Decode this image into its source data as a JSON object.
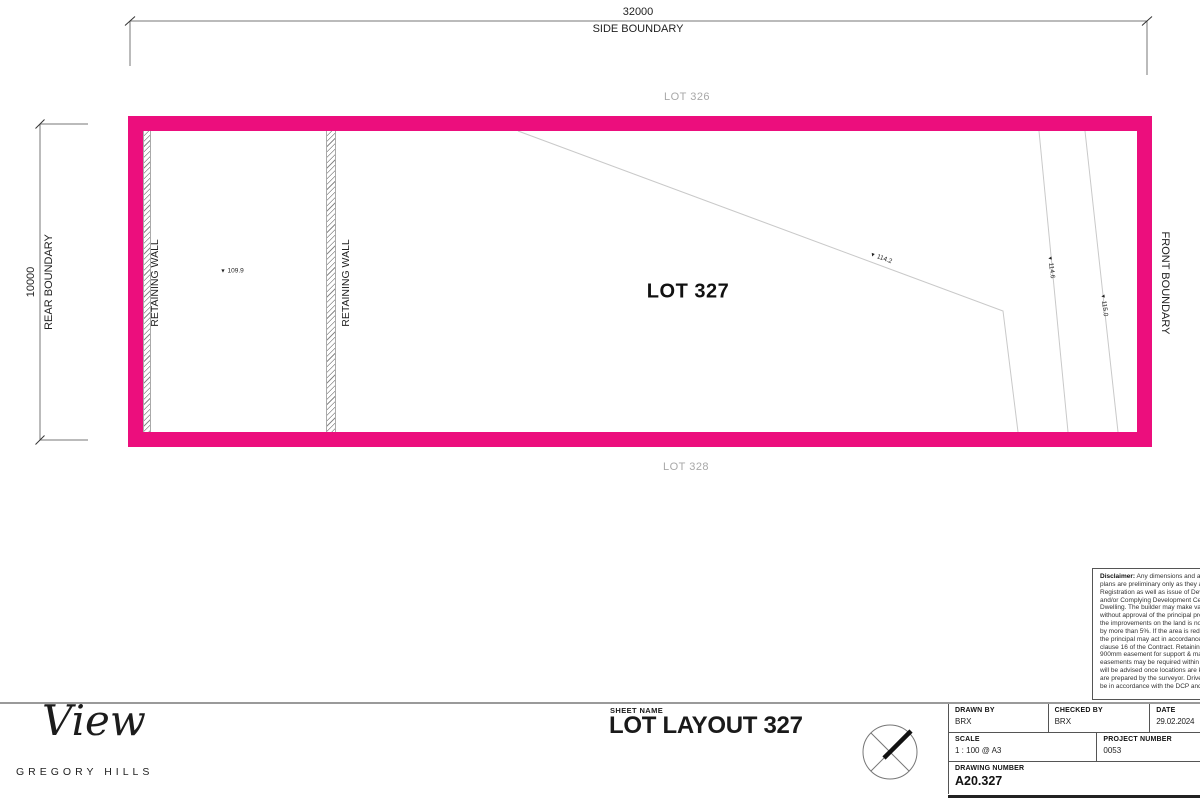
{
  "plan": {
    "dimensions": {
      "top": {
        "value": "32000",
        "label": "SIDE BOUNDARY"
      },
      "left": {
        "value": "10000",
        "label": "REAR BOUNDARY"
      }
    },
    "boundaries": {
      "front_label": "FRONT BOUNDARY"
    },
    "lots": {
      "current": "LOT 327",
      "adjacent_top": "LOT 326",
      "adjacent_bottom": "LOT 328"
    },
    "retaining_walls": [
      {
        "label": "RETAINING WALL"
      },
      {
        "label": "RETAINING WALL"
      }
    ],
    "spot_levels": [
      {
        "value": "109.9"
      },
      {
        "value": "114.2"
      },
      {
        "value": "114.6"
      },
      {
        "value": "115.0"
      }
    ],
    "colors": {
      "boundary_pink": "#EC0E7D",
      "contour_gray": "#c9c9c9",
      "lot_label_gray": "#a8a8a8"
    }
  },
  "icons": {
    "spot_marker": "▼"
  },
  "disclaimer": {
    "heading": "Disclaimer:",
    "lines": [
      " Any dimensions and areas no",
      "plans are preliminary only as they are sub",
      "Registration as well as issue of Developm",
      "and/or Complying Development Certificate",
      "Dwelling. The builder may make variations",
      "without approval of the principal provided",
      "the improvements on the land is not reduc",
      "by more than 5%. If the area is reduced by",
      "the principal may act in accordance with th",
      "clause 16 of the Contract. Retaining walls",
      "900mm easement for support & maintena",
      "easements may be required within lots. Su",
      "will be advised once locations are known,",
      "are prepared by the surveyor. Driveway lo",
      "be in accordance with the DCP and conse"
    ]
  },
  "logo": {
    "name": "View",
    "subtitle": "GREGORY HILLS"
  },
  "title_block": {
    "sheet_name_label": "SHEET NAME",
    "sheet_name": "LOT LAYOUT 327",
    "drawn_by_label": "DRAWN BY",
    "drawn_by": "BRX",
    "checked_by_label": "CHECKED BY",
    "checked_by": "BRX",
    "date_label": "DATE",
    "date": "29.02.2024",
    "scale_label": "SCALE",
    "scale": "1 : 100 @ A3",
    "project_number_label": "PROJECT NUMBER",
    "project_number": "0053",
    "drawing_number_label": "DRAWING NUMBER",
    "drawing_number": "A20.327"
  }
}
